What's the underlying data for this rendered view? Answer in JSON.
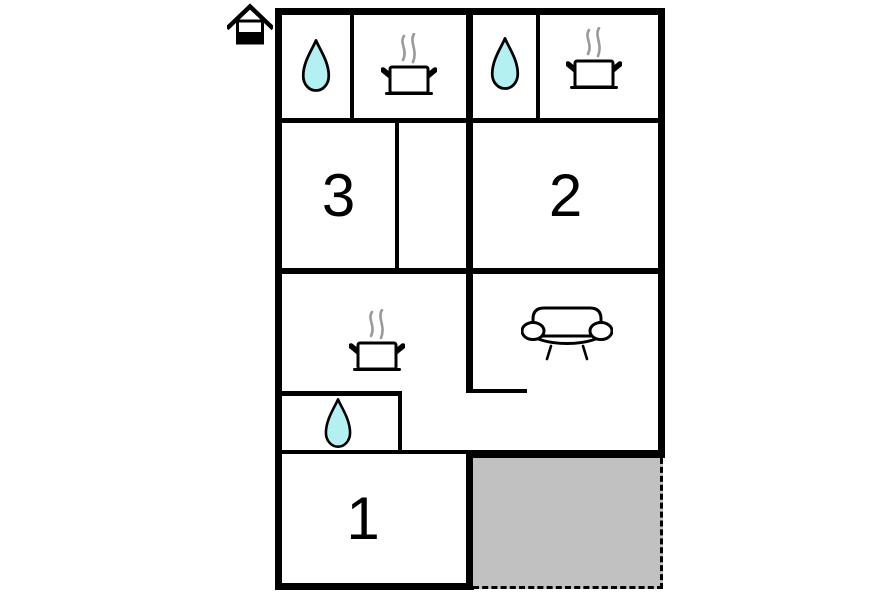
{
  "plan": {
    "type": "floor-plan",
    "rooms": [
      {
        "id": "room-3",
        "label": "3"
      },
      {
        "id": "room-2",
        "label": "2"
      },
      {
        "id": "room-1",
        "label": "1"
      }
    ],
    "icons": {
      "house": "house-icon",
      "water_drop": "water-drop-icon",
      "stove": "cooking-pot-icon",
      "sofa": "sofa-icon"
    },
    "icon_counts": {
      "water_drops": 3,
      "stoves": 3,
      "sofas": 1
    },
    "colors": {
      "wall": "#000000",
      "water_drop_fill": "#b4f0f2",
      "steam": "#9a9a9a",
      "terrace_fill": "#c1c1c1",
      "background": "#ffffff"
    }
  }
}
